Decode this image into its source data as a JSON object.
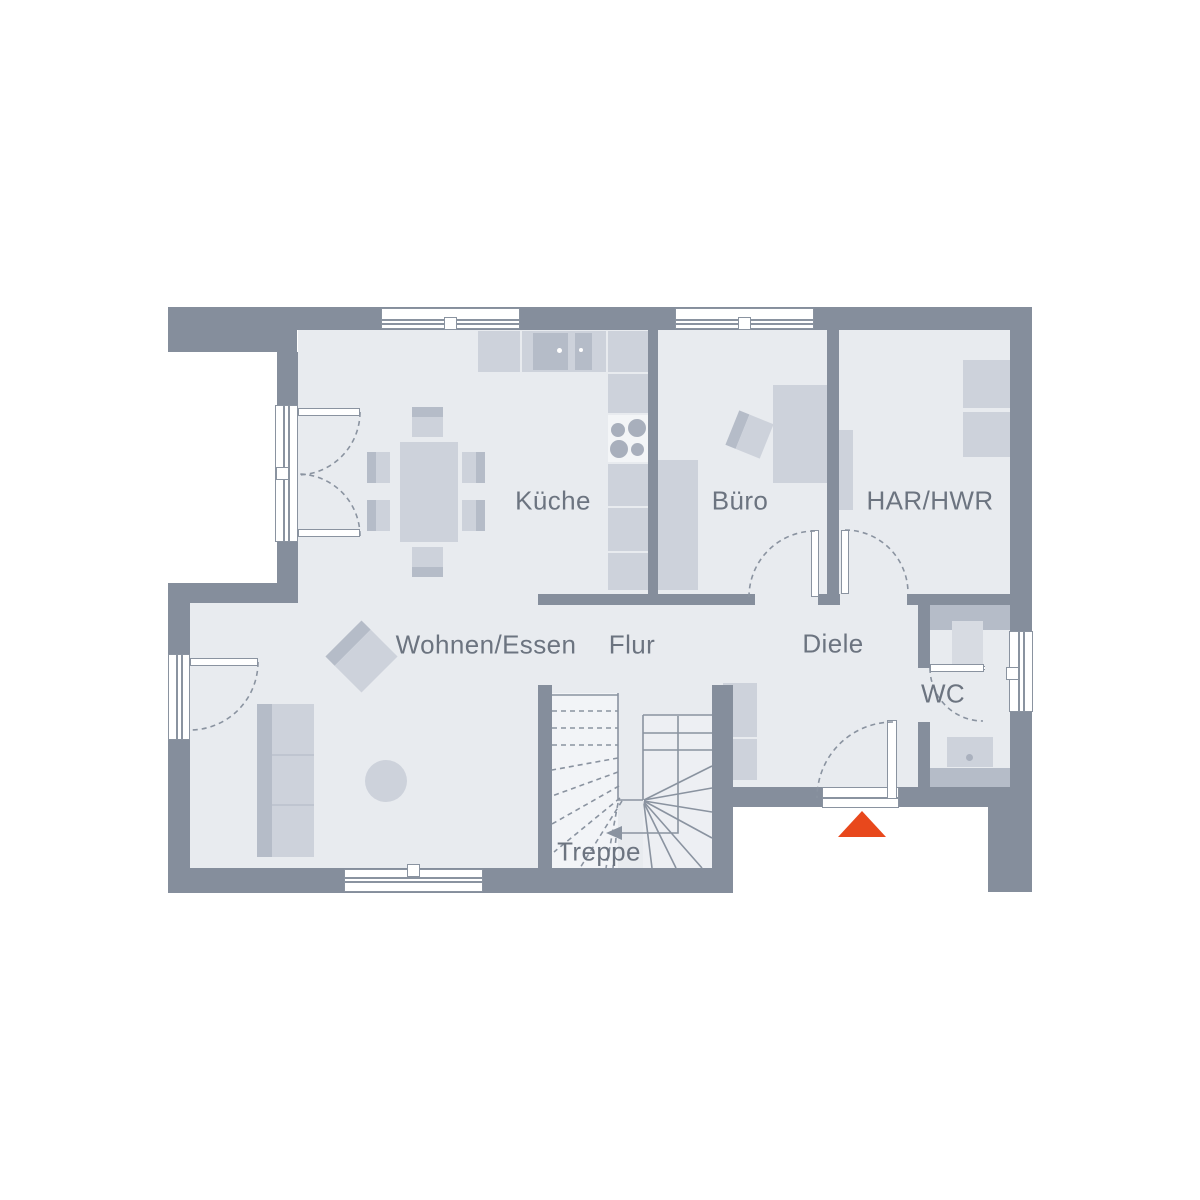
{
  "plan": {
    "type": "floor-plan",
    "rooms": {
      "kueche": {
        "label": "Küche"
      },
      "buero": {
        "label": "Büro"
      },
      "har_hwr": {
        "label": "HAR/HWR"
      },
      "wohnen_essen": {
        "label": "Wohnen/Essen"
      },
      "flur": {
        "label": "Flur"
      },
      "diele": {
        "label": "Diele"
      },
      "wc": {
        "label": "WC"
      },
      "treppe": {
        "label": "Treppe"
      }
    },
    "markers": {
      "entrance": {
        "shape": "triangle-up",
        "color": "#E8481C"
      }
    },
    "palette": {
      "wall": "#858E9C",
      "floor": "#E8EBEF",
      "furniture_light": "#CDD2DB",
      "furniture_medium": "#B5BCC8",
      "line": "#8A93A0",
      "label_text": "#6C7480",
      "background": "#FFFFFF"
    }
  }
}
